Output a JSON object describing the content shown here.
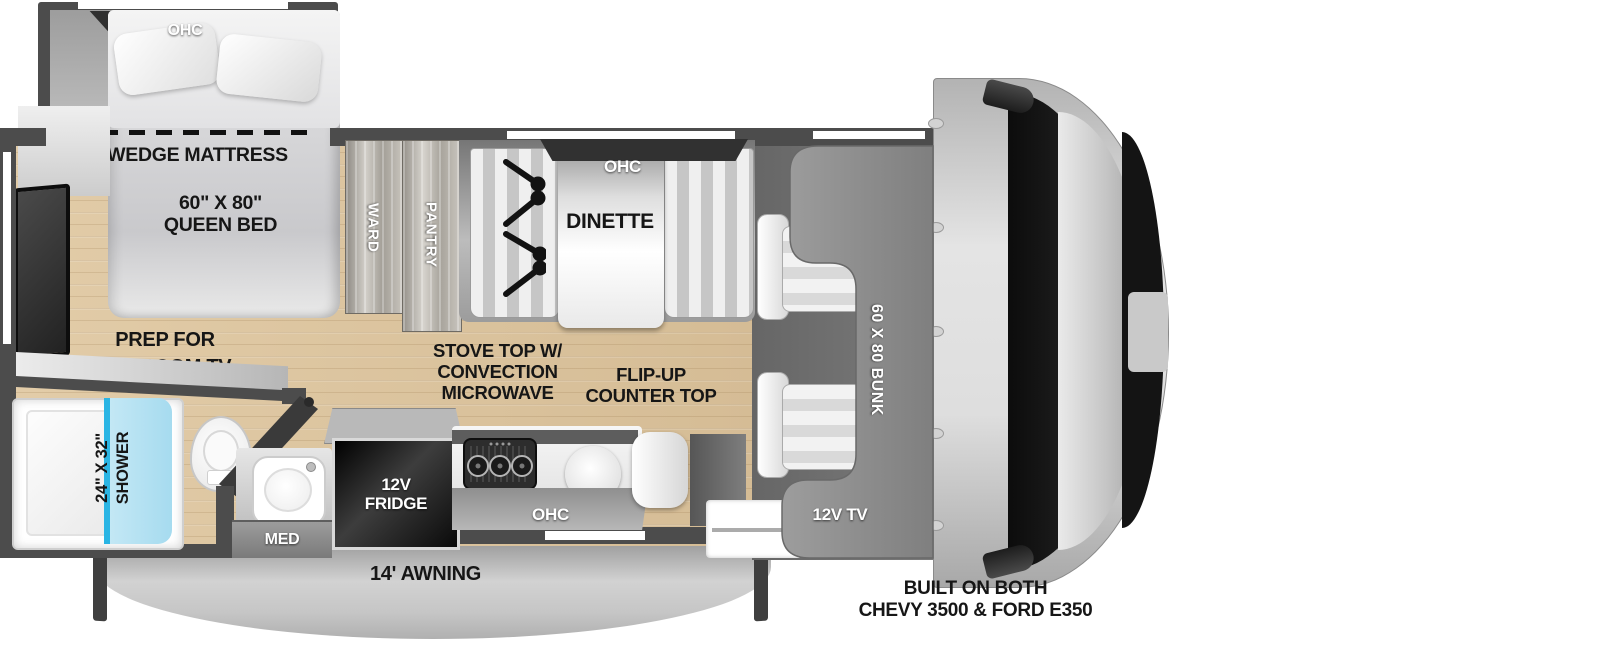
{
  "colors": {
    "wall": "#4c4c4c",
    "floor": "#ddc5a0",
    "shower_glass": "#aadcee",
    "glass_edge": "#2ab5e4",
    "bunk": "#8f8f8f",
    "ohc_cabinet": "#323232",
    "label_dark": "#161616",
    "label_light": "#ffffff"
  },
  "bedroom": {
    "ohc_label": "OHC",
    "wedge_label": "WEDGE MATTRESS",
    "bed_label": "60\" X 80\"\nQUEEN BED",
    "tv_label": "PREP FOR\nBEDROOM TV"
  },
  "storage": {
    "ward_label": "WARD",
    "pantry_label": "PANTRY"
  },
  "dinette": {
    "ohc_label": "OHC",
    "label": "DINETTE"
  },
  "kitchen": {
    "stove_label": "STOVE TOP W/\nCONVECTION\nMICROWAVE",
    "flip_up_label": "FLIP-UP\nCOUNTER TOP",
    "ohc_label": "OHC",
    "fridge_label": "12V\nFRIDGE"
  },
  "bathroom": {
    "shower_label": "24\" X 32\"\nSHOWER",
    "med_label": "MED"
  },
  "cab": {
    "bunk_label": "60 X 80 BUNK",
    "tv_label": "12V TV"
  },
  "exterior": {
    "awning_label": "14' AWNING",
    "chassis_label": "BUILT ON BOTH\nCHEVY 3500 & FORD E350"
  }
}
